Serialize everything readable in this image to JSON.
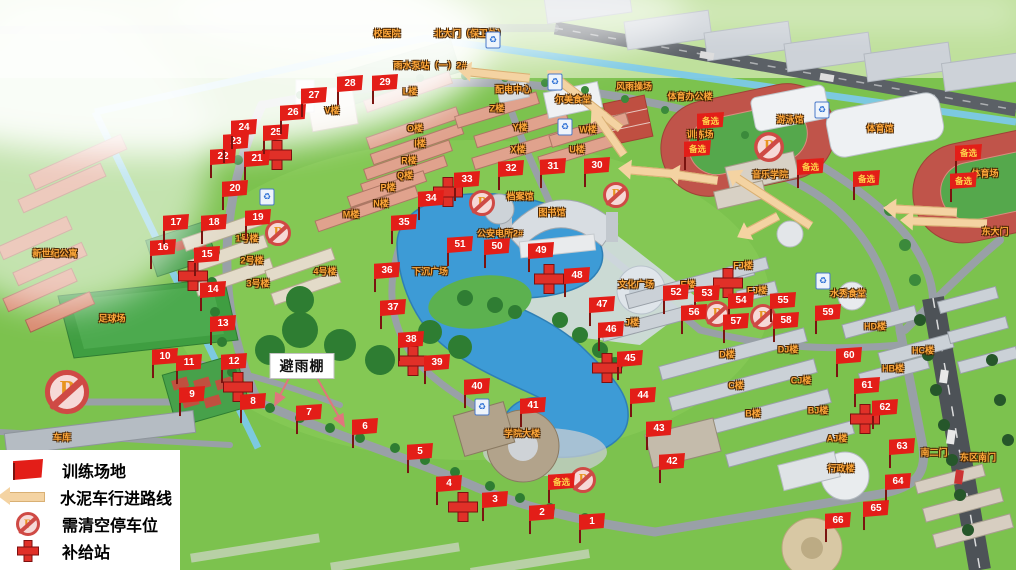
{
  "legend": {
    "items": [
      {
        "icon": "training-flag-icon",
        "label": "训练场地"
      },
      {
        "icon": "route-arrow-icon",
        "label": "水泥车行进路线"
      },
      {
        "icon": "no-parking-icon",
        "label": "需清空停车位"
      },
      {
        "icon": "supply-cross-icon",
        "label": "补给站"
      }
    ]
  },
  "shelter_callout": {
    "text": "避雨棚",
    "x": 302,
    "y": 366,
    "targets": [
      [
        275,
        405
      ],
      [
        344,
        426
      ]
    ]
  },
  "flags": [
    {
      "n": "1",
      "x": 592,
      "y": 522
    },
    {
      "n": "2",
      "x": 542,
      "y": 513
    },
    {
      "n": "3",
      "x": 495,
      "y": 500
    },
    {
      "n": "4",
      "x": 449,
      "y": 484
    },
    {
      "n": "5",
      "x": 420,
      "y": 452
    },
    {
      "n": "6",
      "x": 365,
      "y": 427
    },
    {
      "n": "7",
      "x": 309,
      "y": 413
    },
    {
      "n": "8",
      "x": 253,
      "y": 402
    },
    {
      "n": "9",
      "x": 192,
      "y": 395
    },
    {
      "n": "10",
      "x": 165,
      "y": 357
    },
    {
      "n": "11",
      "x": 189,
      "y": 363
    },
    {
      "n": "12",
      "x": 234,
      "y": 362
    },
    {
      "n": "13",
      "x": 223,
      "y": 324
    },
    {
      "n": "14",
      "x": 213,
      "y": 290
    },
    {
      "n": "15",
      "x": 207,
      "y": 255
    },
    {
      "n": "16",
      "x": 163,
      "y": 248
    },
    {
      "n": "17",
      "x": 176,
      "y": 223
    },
    {
      "n": "18",
      "x": 214,
      "y": 223
    },
    {
      "n": "19",
      "x": 258,
      "y": 218
    },
    {
      "n": "20",
      "x": 235,
      "y": 189
    },
    {
      "n": "21",
      "x": 257,
      "y": 159
    },
    {
      "n": "22",
      "x": 223,
      "y": 157
    },
    {
      "n": "23",
      "x": 236,
      "y": 142
    },
    {
      "n": "24",
      "x": 244,
      "y": 128
    },
    {
      "n": "25",
      "x": 276,
      "y": 133
    },
    {
      "n": "26",
      "x": 293,
      "y": 113
    },
    {
      "n": "27",
      "x": 314,
      "y": 96
    },
    {
      "n": "28",
      "x": 350,
      "y": 84
    },
    {
      "n": "29",
      "x": 385,
      "y": 83
    },
    {
      "n": "30",
      "x": 597,
      "y": 166
    },
    {
      "n": "31",
      "x": 553,
      "y": 167
    },
    {
      "n": "32",
      "x": 511,
      "y": 169
    },
    {
      "n": "33",
      "x": 467,
      "y": 180
    },
    {
      "n": "34",
      "x": 431,
      "y": 199
    },
    {
      "n": "35",
      "x": 404,
      "y": 223
    },
    {
      "n": "36",
      "x": 387,
      "y": 271
    },
    {
      "n": "37",
      "x": 393,
      "y": 308
    },
    {
      "n": "38",
      "x": 411,
      "y": 340
    },
    {
      "n": "39",
      "x": 437,
      "y": 363
    },
    {
      "n": "40",
      "x": 477,
      "y": 387
    },
    {
      "n": "41",
      "x": 533,
      "y": 406
    },
    {
      "n": "42",
      "x": 672,
      "y": 462
    },
    {
      "n": "43",
      "x": 659,
      "y": 429
    },
    {
      "n": "44",
      "x": 643,
      "y": 396
    },
    {
      "n": "45",
      "x": 630,
      "y": 359
    },
    {
      "n": "46",
      "x": 611,
      "y": 330
    },
    {
      "n": "47",
      "x": 602,
      "y": 305
    },
    {
      "n": "48",
      "x": 577,
      "y": 276
    },
    {
      "n": "49",
      "x": 541,
      "y": 251
    },
    {
      "n": "50",
      "x": 497,
      "y": 247
    },
    {
      "n": "51",
      "x": 460,
      "y": 245
    },
    {
      "n": "52",
      "x": 676,
      "y": 293
    },
    {
      "n": "53",
      "x": 707,
      "y": 294
    },
    {
      "n": "54",
      "x": 741,
      "y": 301
    },
    {
      "n": "55",
      "x": 783,
      "y": 301
    },
    {
      "n": "56",
      "x": 694,
      "y": 313
    },
    {
      "n": "57",
      "x": 736,
      "y": 322
    },
    {
      "n": "58",
      "x": 786,
      "y": 321
    },
    {
      "n": "59",
      "x": 828,
      "y": 313
    },
    {
      "n": "60",
      "x": 849,
      "y": 356
    },
    {
      "n": "61",
      "x": 867,
      "y": 386
    },
    {
      "n": "62",
      "x": 885,
      "y": 408
    },
    {
      "n": "63",
      "x": 902,
      "y": 447
    },
    {
      "n": "64",
      "x": 898,
      "y": 482
    },
    {
      "n": "65",
      "x": 876,
      "y": 509
    },
    {
      "n": "66",
      "x": 838,
      "y": 521
    }
  ],
  "alt_flags": [
    {
      "label": "备选",
      "x": 710,
      "y": 121
    },
    {
      "label": "备选",
      "x": 697,
      "y": 149
    },
    {
      "label": "备选",
      "x": 810,
      "y": 167
    },
    {
      "label": "备选",
      "x": 866,
      "y": 179
    },
    {
      "label": "备选",
      "x": 968,
      "y": 153
    },
    {
      "label": "备选",
      "x": 963,
      "y": 181
    },
    {
      "label": "备选",
      "x": 561,
      "y": 482
    }
  ],
  "supply_stations": [
    [
      277,
      155
    ],
    [
      448,
      192
    ],
    [
      193,
      276
    ],
    [
      238,
      387
    ],
    [
      413,
      361
    ],
    [
      463,
      507
    ],
    [
      549,
      279
    ],
    [
      728,
      283
    ],
    [
      607,
      368
    ],
    [
      865,
      419
    ]
  ],
  "no_parking": [
    {
      "x": 67,
      "y": 392,
      "s": 1.7
    },
    {
      "x": 278,
      "y": 233,
      "s": 1
    },
    {
      "x": 482,
      "y": 203,
      "s": 1
    },
    {
      "x": 616,
      "y": 195,
      "s": 1
    },
    {
      "x": 717,
      "y": 314,
      "s": 1
    },
    {
      "x": 763,
      "y": 317,
      "s": 1
    },
    {
      "x": 769,
      "y": 147,
      "s": 1.15
    },
    {
      "x": 583,
      "y": 480,
      "s": 1
    }
  ],
  "route_arrows": [
    {
      "x": 470,
      "y": 72,
      "len": 60,
      "angle": 6
    },
    {
      "x": 556,
      "y": 78,
      "len": 82,
      "angle": 38
    },
    {
      "x": 598,
      "y": 118,
      "len": 45,
      "angle": 55
    },
    {
      "x": 630,
      "y": 170,
      "len": 42,
      "angle": 5
    },
    {
      "x": 678,
      "y": 175,
      "len": 40,
      "angle": 8
    },
    {
      "x": 737,
      "y": 178,
      "len": 88,
      "angle": 33
    },
    {
      "x": 748,
      "y": 232,
      "len": 34,
      "angle": -28
    },
    {
      "x": 895,
      "y": 209,
      "len": 62,
      "angle": 3
    },
    {
      "x": 912,
      "y": 221,
      "len": 75,
      "angle": 2
    }
  ],
  "map_labels": [
    {
      "text": "足球场",
      "x": 112,
      "y": 318
    },
    {
      "text": "训练场",
      "x": 700,
      "y": 134
    },
    {
      "text": "体育场",
      "x": 985,
      "y": 173
    },
    {
      "text": "体育馆",
      "x": 880,
      "y": 128
    },
    {
      "text": "游泳馆",
      "x": 790,
      "y": 119
    },
    {
      "text": "音乐学院",
      "x": 770,
      "y": 174
    },
    {
      "text": "图书馆",
      "x": 552,
      "y": 212
    },
    {
      "text": "档案馆",
      "x": 520,
      "y": 196
    },
    {
      "text": "文化广场",
      "x": 636,
      "y": 284
    },
    {
      "text": "下沉广场",
      "x": 430,
      "y": 271
    },
    {
      "text": "学院大楼",
      "x": 522,
      "y": 433
    },
    {
      "text": "行政楼",
      "x": 841,
      "y": 468
    },
    {
      "text": "北大门（保卫处）",
      "x": 470,
      "y": 33
    },
    {
      "text": "校医院",
      "x": 387,
      "y": 33
    },
    {
      "text": "东大门",
      "x": 995,
      "y": 231
    },
    {
      "text": "南二门",
      "x": 934,
      "y": 452
    },
    {
      "text": "东区南门",
      "x": 978,
      "y": 457
    },
    {
      "text": "风雨操场",
      "x": 634,
      "y": 86
    },
    {
      "text": "体育办公楼",
      "x": 690,
      "y": 96
    },
    {
      "text": "尔美食堂",
      "x": 573,
      "y": 99
    },
    {
      "text": "水秀食堂",
      "x": 848,
      "y": 293
    },
    {
      "text": "配电中心",
      "x": 513,
      "y": 89
    },
    {
      "text": "雨水泵站（一）2#",
      "x": 430,
      "y": 65
    },
    {
      "text": "公安电所2#",
      "x": 500,
      "y": 233
    },
    {
      "text": "1号楼",
      "x": 247,
      "y": 238
    },
    {
      "text": "2号楼",
      "x": 252,
      "y": 260
    },
    {
      "text": "3号楼",
      "x": 258,
      "y": 283
    },
    {
      "text": "4号楼",
      "x": 325,
      "y": 271
    },
    {
      "text": "V楼",
      "x": 332,
      "y": 110
    },
    {
      "text": "L楼",
      "x": 410,
      "y": 91
    },
    {
      "text": "O楼",
      "x": 415,
      "y": 128
    },
    {
      "text": "I楼",
      "x": 420,
      "y": 143
    },
    {
      "text": "R楼",
      "x": 409,
      "y": 160
    },
    {
      "text": "Q楼",
      "x": 405,
      "y": 175
    },
    {
      "text": "P楼",
      "x": 388,
      "y": 187
    },
    {
      "text": "N楼",
      "x": 381,
      "y": 203
    },
    {
      "text": "M楼",
      "x": 351,
      "y": 214
    },
    {
      "text": "Z楼",
      "x": 497,
      "y": 108
    },
    {
      "text": "Y楼",
      "x": 520,
      "y": 127
    },
    {
      "text": "X楼",
      "x": 518,
      "y": 149
    },
    {
      "text": "W楼",
      "x": 588,
      "y": 129
    },
    {
      "text": "U楼",
      "x": 577,
      "y": 149
    },
    {
      "text": "E楼",
      "x": 688,
      "y": 284
    },
    {
      "text": "EJ楼",
      "x": 757,
      "y": 290
    },
    {
      "text": "FJ楼",
      "x": 743,
      "y": 265
    },
    {
      "text": "J楼",
      "x": 632,
      "y": 322
    },
    {
      "text": "D楼",
      "x": 727,
      "y": 354
    },
    {
      "text": "DJ楼",
      "x": 788,
      "y": 349
    },
    {
      "text": "C楼",
      "x": 736,
      "y": 385
    },
    {
      "text": "CJ楼",
      "x": 801,
      "y": 380
    },
    {
      "text": "B楼",
      "x": 753,
      "y": 413
    },
    {
      "text": "BJ楼",
      "x": 818,
      "y": 410
    },
    {
      "text": "AJ楼",
      "x": 837,
      "y": 438
    },
    {
      "text": "HD楼",
      "x": 875,
      "y": 326
    },
    {
      "text": "HC楼",
      "x": 923,
      "y": 350
    },
    {
      "text": "HB楼",
      "x": 893,
      "y": 368
    },
    {
      "text": "车库",
      "x": 62,
      "y": 437
    },
    {
      "text": "新世纪公寓",
      "x": 55,
      "y": 253
    }
  ],
  "recycle_icons": [
    [
      267,
      197
    ],
    [
      493,
      40
    ],
    [
      555,
      82
    ],
    [
      565,
      127
    ],
    [
      822,
      110
    ],
    [
      823,
      281
    ],
    [
      482,
      407
    ]
  ],
  "colors": {
    "flag": "#e31e18",
    "cross": "#e03028",
    "label": "#ffa83a",
    "arrowc": "#f4d3a2",
    "water": "#3d9bd6"
  }
}
